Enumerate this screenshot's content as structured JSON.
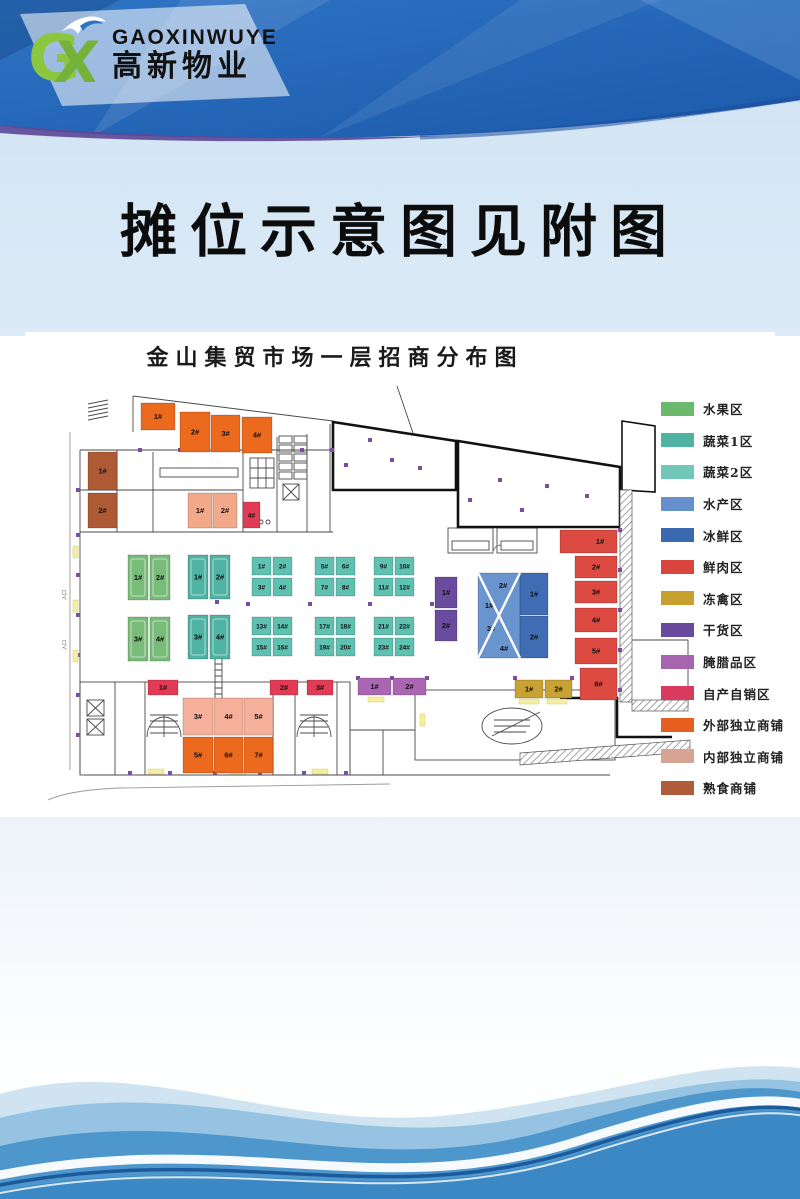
{
  "header": {
    "brand_latin": "GAOXINWUYE",
    "brand_cn": "高新物业",
    "mark_g": "G",
    "mark_x": "X"
  },
  "notice_title": "摊位示意图见附图",
  "plan": {
    "title": "金山集贸市场一层招商分布图",
    "annotations": {
      "entrance": "入口"
    },
    "legend": [
      {
        "label": "水果区",
        "color": "#6cb96d"
      },
      {
        "label": "蔬菜1区",
        "color": "#4fb3a4"
      },
      {
        "label": "蔬菜2区",
        "color": "#72c8b8"
      },
      {
        "label": "水产区",
        "color": "#6590cc"
      },
      {
        "label": "冰鲜区",
        "color": "#3b69b0"
      },
      {
        "label": "鲜肉区",
        "color": "#d9453c"
      },
      {
        "label": "冻禽区",
        "color": "#c8a02f"
      },
      {
        "label": "干货区",
        "color": "#6a4a9d"
      },
      {
        "label": "腌腊品区",
        "color": "#a765af"
      },
      {
        "label": "自产自销区",
        "color": "#d93a60"
      },
      {
        "label": "外部独立商铺",
        "color": "#e55f1e"
      },
      {
        "label": "内部独立商铺",
        "color": "#d6a395"
      },
      {
        "label": "熟食商铺",
        "color": "#b05c39"
      }
    ],
    "stalls": [
      {
        "zone": "外部独立商铺",
        "l": "1#",
        "x": 141,
        "y": 403,
        "w": 34,
        "h": 27,
        "c": "#ec6a1e"
      },
      {
        "zone": "外部独立商铺",
        "l": "2#",
        "x": 180,
        "y": 412,
        "w": 30,
        "h": 40,
        "c": "#ec6a1e"
      },
      {
        "zone": "外部独立商铺",
        "l": "3#",
        "x": 211,
        "y": 415,
        "w": 29,
        "h": 37,
        "c": "#ec6a1e"
      },
      {
        "zone": "外部独立商铺",
        "l": "4#",
        "x": 242,
        "y": 417,
        "w": 30,
        "h": 36,
        "c": "#ec6a1e"
      },
      {
        "zone": "外部独立商铺",
        "l": "5#",
        "x": 183,
        "y": 737,
        "w": 30,
        "h": 36,
        "c": "#ec6a1e"
      },
      {
        "zone": "外部独立商铺",
        "l": "6#",
        "x": 214,
        "y": 737,
        "w": 29,
        "h": 36,
        "c": "#ec6a1e"
      },
      {
        "zone": "外部独立商铺",
        "l": "7#",
        "x": 244,
        "y": 737,
        "w": 29,
        "h": 36,
        "c": "#ec6a1e"
      },
      {
        "zone": "熟食商铺",
        "l": "1#",
        "x": 88,
        "y": 452,
        "w": 29,
        "h": 38,
        "c": "#ad5a35"
      },
      {
        "zone": "熟食商铺",
        "l": "2#",
        "x": 88,
        "y": 493,
        "w": 29,
        "h": 35,
        "c": "#ad5a35"
      },
      {
        "zone": "内部独立商铺",
        "l": "1#",
        "x": 188,
        "y": 493,
        "w": 24,
        "h": 35,
        "c": "#f2a98a"
      },
      {
        "zone": "内部独立商铺",
        "l": "2#",
        "x": 213,
        "y": 493,
        "w": 24,
        "h": 35,
        "c": "#f2a98a"
      },
      {
        "zone": "内部独立商铺",
        "l": "3#",
        "x": 183,
        "y": 698,
        "w": 30,
        "h": 37,
        "c": "#f4b09a"
      },
      {
        "zone": "内部独立商铺",
        "l": "4#",
        "x": 214,
        "y": 698,
        "w": 29,
        "h": 37,
        "c": "#f4b09a"
      },
      {
        "zone": "内部独立商铺",
        "l": "5#",
        "x": 244,
        "y": 698,
        "w": 29,
        "h": 37,
        "c": "#f4b09a"
      },
      {
        "zone": "自产自销区",
        "l": "4#",
        "x": 243,
        "y": 502,
        "w": 17,
        "h": 26,
        "c": "#e23b55"
      },
      {
        "zone": "自产自销区",
        "l": "1#",
        "x": 148,
        "y": 680,
        "w": 30,
        "h": 15,
        "c": "#e23b55"
      },
      {
        "zone": "自产自销区",
        "l": "2#",
        "x": 270,
        "y": 680,
        "w": 28,
        "h": 15,
        "c": "#e23b55"
      },
      {
        "zone": "自产自销区",
        "l": "3#",
        "x": 307,
        "y": 680,
        "w": 26,
        "h": 15,
        "c": "#e23b55"
      },
      {
        "zone": "水果区",
        "l": "1#",
        "x": 128,
        "y": 555,
        "w": 20,
        "h": 45,
        "c": "#79bc79",
        "in": 1
      },
      {
        "zone": "水果区",
        "l": "2#",
        "x": 150,
        "y": 555,
        "w": 20,
        "h": 45,
        "c": "#79bc79",
        "in": 1
      },
      {
        "zone": "水果区",
        "l": "3#",
        "x": 128,
        "y": 617,
        "w": 20,
        "h": 44,
        "c": "#79bc79",
        "in": 1
      },
      {
        "zone": "水果区",
        "l": "4#",
        "x": 150,
        "y": 617,
        "w": 20,
        "h": 44,
        "c": "#79bc79",
        "in": 1
      },
      {
        "zone": "蔬菜1区",
        "l": "1#",
        "x": 188,
        "y": 555,
        "w": 20,
        "h": 44,
        "c": "#4fb2a3",
        "in": 1
      },
      {
        "zone": "蔬菜1区",
        "l": "2#",
        "x": 210,
        "y": 555,
        "w": 20,
        "h": 44,
        "c": "#4fb2a3",
        "in": 1
      },
      {
        "zone": "蔬菜1区",
        "l": "3#",
        "x": 188,
        "y": 615,
        "w": 20,
        "h": 44,
        "c": "#4fb2a3",
        "in": 1
      },
      {
        "zone": "蔬菜1区",
        "l": "4#",
        "x": 210,
        "y": 615,
        "w": 20,
        "h": 44,
        "c": "#4fb2a3",
        "in": 1
      },
      {
        "zone": "蔬菜2区",
        "l": "1#",
        "x": 252,
        "y": 557,
        "w": 19,
        "h": 18,
        "c": "#5fc1b2"
      },
      {
        "zone": "蔬菜2区",
        "l": "2#",
        "x": 273,
        "y": 557,
        "w": 19,
        "h": 18,
        "c": "#5fc1b2"
      },
      {
        "zone": "蔬菜2区",
        "l": "3#",
        "x": 252,
        "y": 578,
        "w": 19,
        "h": 18,
        "c": "#5fc1b2"
      },
      {
        "zone": "蔬菜2区",
        "l": "4#",
        "x": 273,
        "y": 578,
        "w": 19,
        "h": 18,
        "c": "#5fc1b2"
      },
      {
        "zone": "蔬菜2区",
        "l": "5#",
        "x": 315,
        "y": 557,
        "w": 19,
        "h": 18,
        "c": "#5fc1b2"
      },
      {
        "zone": "蔬菜2区",
        "l": "6#",
        "x": 336,
        "y": 557,
        "w": 19,
        "h": 18,
        "c": "#5fc1b2"
      },
      {
        "zone": "蔬菜2区",
        "l": "7#",
        "x": 315,
        "y": 578,
        "w": 19,
        "h": 18,
        "c": "#5fc1b2"
      },
      {
        "zone": "蔬菜2区",
        "l": "8#",
        "x": 336,
        "y": 578,
        "w": 19,
        "h": 18,
        "c": "#5fc1b2"
      },
      {
        "zone": "蔬菜2区",
        "l": "9#",
        "x": 374,
        "y": 557,
        "w": 19,
        "h": 18,
        "c": "#5fc1b2"
      },
      {
        "zone": "蔬菜2区",
        "l": "10#",
        "x": 395,
        "y": 557,
        "w": 19,
        "h": 18,
        "c": "#5fc1b2"
      },
      {
        "zone": "蔬菜2区",
        "l": "11#",
        "x": 374,
        "y": 578,
        "w": 19,
        "h": 18,
        "c": "#5fc1b2"
      },
      {
        "zone": "蔬菜2区",
        "l": "12#",
        "x": 395,
        "y": 578,
        "w": 19,
        "h": 18,
        "c": "#5fc1b2"
      },
      {
        "zone": "蔬菜2区",
        "l": "13#",
        "x": 252,
        "y": 617,
        "w": 19,
        "h": 18,
        "c": "#5fc1b2"
      },
      {
        "zone": "蔬菜2区",
        "l": "14#",
        "x": 273,
        "y": 617,
        "w": 19,
        "h": 18,
        "c": "#5fc1b2"
      },
      {
        "zone": "蔬菜2区",
        "l": "15#",
        "x": 252,
        "y": 638,
        "w": 19,
        "h": 18,
        "c": "#5fc1b2"
      },
      {
        "zone": "蔬菜2区",
        "l": "16#",
        "x": 273,
        "y": 638,
        "w": 19,
        "h": 18,
        "c": "#5fc1b2"
      },
      {
        "zone": "蔬菜2区",
        "l": "17#",
        "x": 315,
        "y": 617,
        "w": 19,
        "h": 18,
        "c": "#5fc1b2"
      },
      {
        "zone": "蔬菜2区",
        "l": "18#",
        "x": 336,
        "y": 617,
        "w": 19,
        "h": 18,
        "c": "#5fc1b2"
      },
      {
        "zone": "蔬菜2区",
        "l": "19#",
        "x": 315,
        "y": 638,
        "w": 19,
        "h": 18,
        "c": "#5fc1b2"
      },
      {
        "zone": "蔬菜2区",
        "l": "20#",
        "x": 336,
        "y": 638,
        "w": 19,
        "h": 18,
        "c": "#5fc1b2"
      },
      {
        "zone": "蔬菜2区",
        "l": "21#",
        "x": 374,
        "y": 617,
        "w": 19,
        "h": 18,
        "c": "#5fc1b2"
      },
      {
        "zone": "蔬菜2区",
        "l": "22#",
        "x": 395,
        "y": 617,
        "w": 19,
        "h": 18,
        "c": "#5fc1b2"
      },
      {
        "zone": "蔬菜2区",
        "l": "23#",
        "x": 374,
        "y": 638,
        "w": 19,
        "h": 18,
        "c": "#5fc1b2"
      },
      {
        "zone": "蔬菜2区",
        "l": "24#",
        "x": 395,
        "y": 638,
        "w": 19,
        "h": 18,
        "c": "#5fc1b2"
      },
      {
        "zone": "干货区",
        "l": "1#",
        "x": 435,
        "y": 577,
        "w": 22,
        "h": 31,
        "c": "#6a4b9d"
      },
      {
        "zone": "干货区",
        "l": "2#",
        "x": 435,
        "y": 610,
        "w": 22,
        "h": 31,
        "c": "#6a4b9d"
      },
      {
        "zone": "水产区",
        "l": "",
        "x": 478,
        "y": 573,
        "w": 42,
        "h": 85,
        "c": "#6a94cd"
      },
      {
        "zone": "水产区",
        "l": "2#",
        "x": 0,
        "y": 0,
        "w": 0,
        "h": 0,
        "c": "#6a94cd",
        "lx": 503,
        "ly": 588
      },
      {
        "zone": "水产区",
        "l": "1#",
        "x": 0,
        "y": 0,
        "w": 0,
        "h": 0,
        "c": "#6a94cd",
        "lx": 489,
        "ly": 608
      },
      {
        "zone": "水产区",
        "l": "3#",
        "x": 0,
        "y": 0,
        "w": 0,
        "h": 0,
        "c": "#6a94cd",
        "lx": 491,
        "ly": 631
      },
      {
        "zone": "水产区",
        "l": "4#",
        "x": 0,
        "y": 0,
        "w": 0,
        "h": 0,
        "c": "#6a94cd",
        "lx": 504,
        "ly": 651
      },
      {
        "zone": "冰鲜区",
        "l": "1#",
        "x": 520,
        "y": 573,
        "w": 28,
        "h": 42,
        "c": "#3f6cb3"
      },
      {
        "zone": "冰鲜区",
        "l": "2#",
        "x": 520,
        "y": 616,
        "w": 28,
        "h": 42,
        "c": "#3f6cb3"
      },
      {
        "zone": "鲜肉区",
        "l": "1#",
        "x": 560,
        "y": 530,
        "w": 57,
        "h": 23,
        "c": "#dd4a42",
        "lx": 600,
        "ly": 544
      },
      {
        "zone": "鲜肉区",
        "l": "2#",
        "x": 575,
        "y": 556,
        "w": 42,
        "h": 22,
        "c": "#dd4a42"
      },
      {
        "zone": "鲜肉区",
        "l": "3#",
        "x": 575,
        "y": 581,
        "w": 42,
        "h": 22,
        "c": "#dd4a42"
      },
      {
        "zone": "鲜肉区",
        "l": "4#",
        "x": 575,
        "y": 608,
        "w": 42,
        "h": 24,
        "c": "#dd4a42"
      },
      {
        "zone": "鲜肉区",
        "l": "5#",
        "x": 575,
        "y": 638,
        "w": 42,
        "h": 26,
        "c": "#dd4a42"
      },
      {
        "zone": "鲜肉区",
        "l": "6#",
        "x": 580,
        "y": 668,
        "w": 37,
        "h": 32,
        "c": "#dd4a42"
      },
      {
        "zone": "冻禽区",
        "l": "1#",
        "x": 515,
        "y": 680,
        "w": 28,
        "h": 18,
        "c": "#c8a233"
      },
      {
        "zone": "冻禽区",
        "l": "2#",
        "x": 545,
        "y": 680,
        "w": 27,
        "h": 18,
        "c": "#c8a233"
      },
      {
        "zone": "腌腊品区",
        "l": "1#",
        "x": 358,
        "y": 678,
        "w": 33,
        "h": 17,
        "c": "#aa66b2"
      },
      {
        "zone": "腌腊品区",
        "l": "2#",
        "x": 393,
        "y": 678,
        "w": 33,
        "h": 17,
        "c": "#aa66b2"
      }
    ]
  }
}
